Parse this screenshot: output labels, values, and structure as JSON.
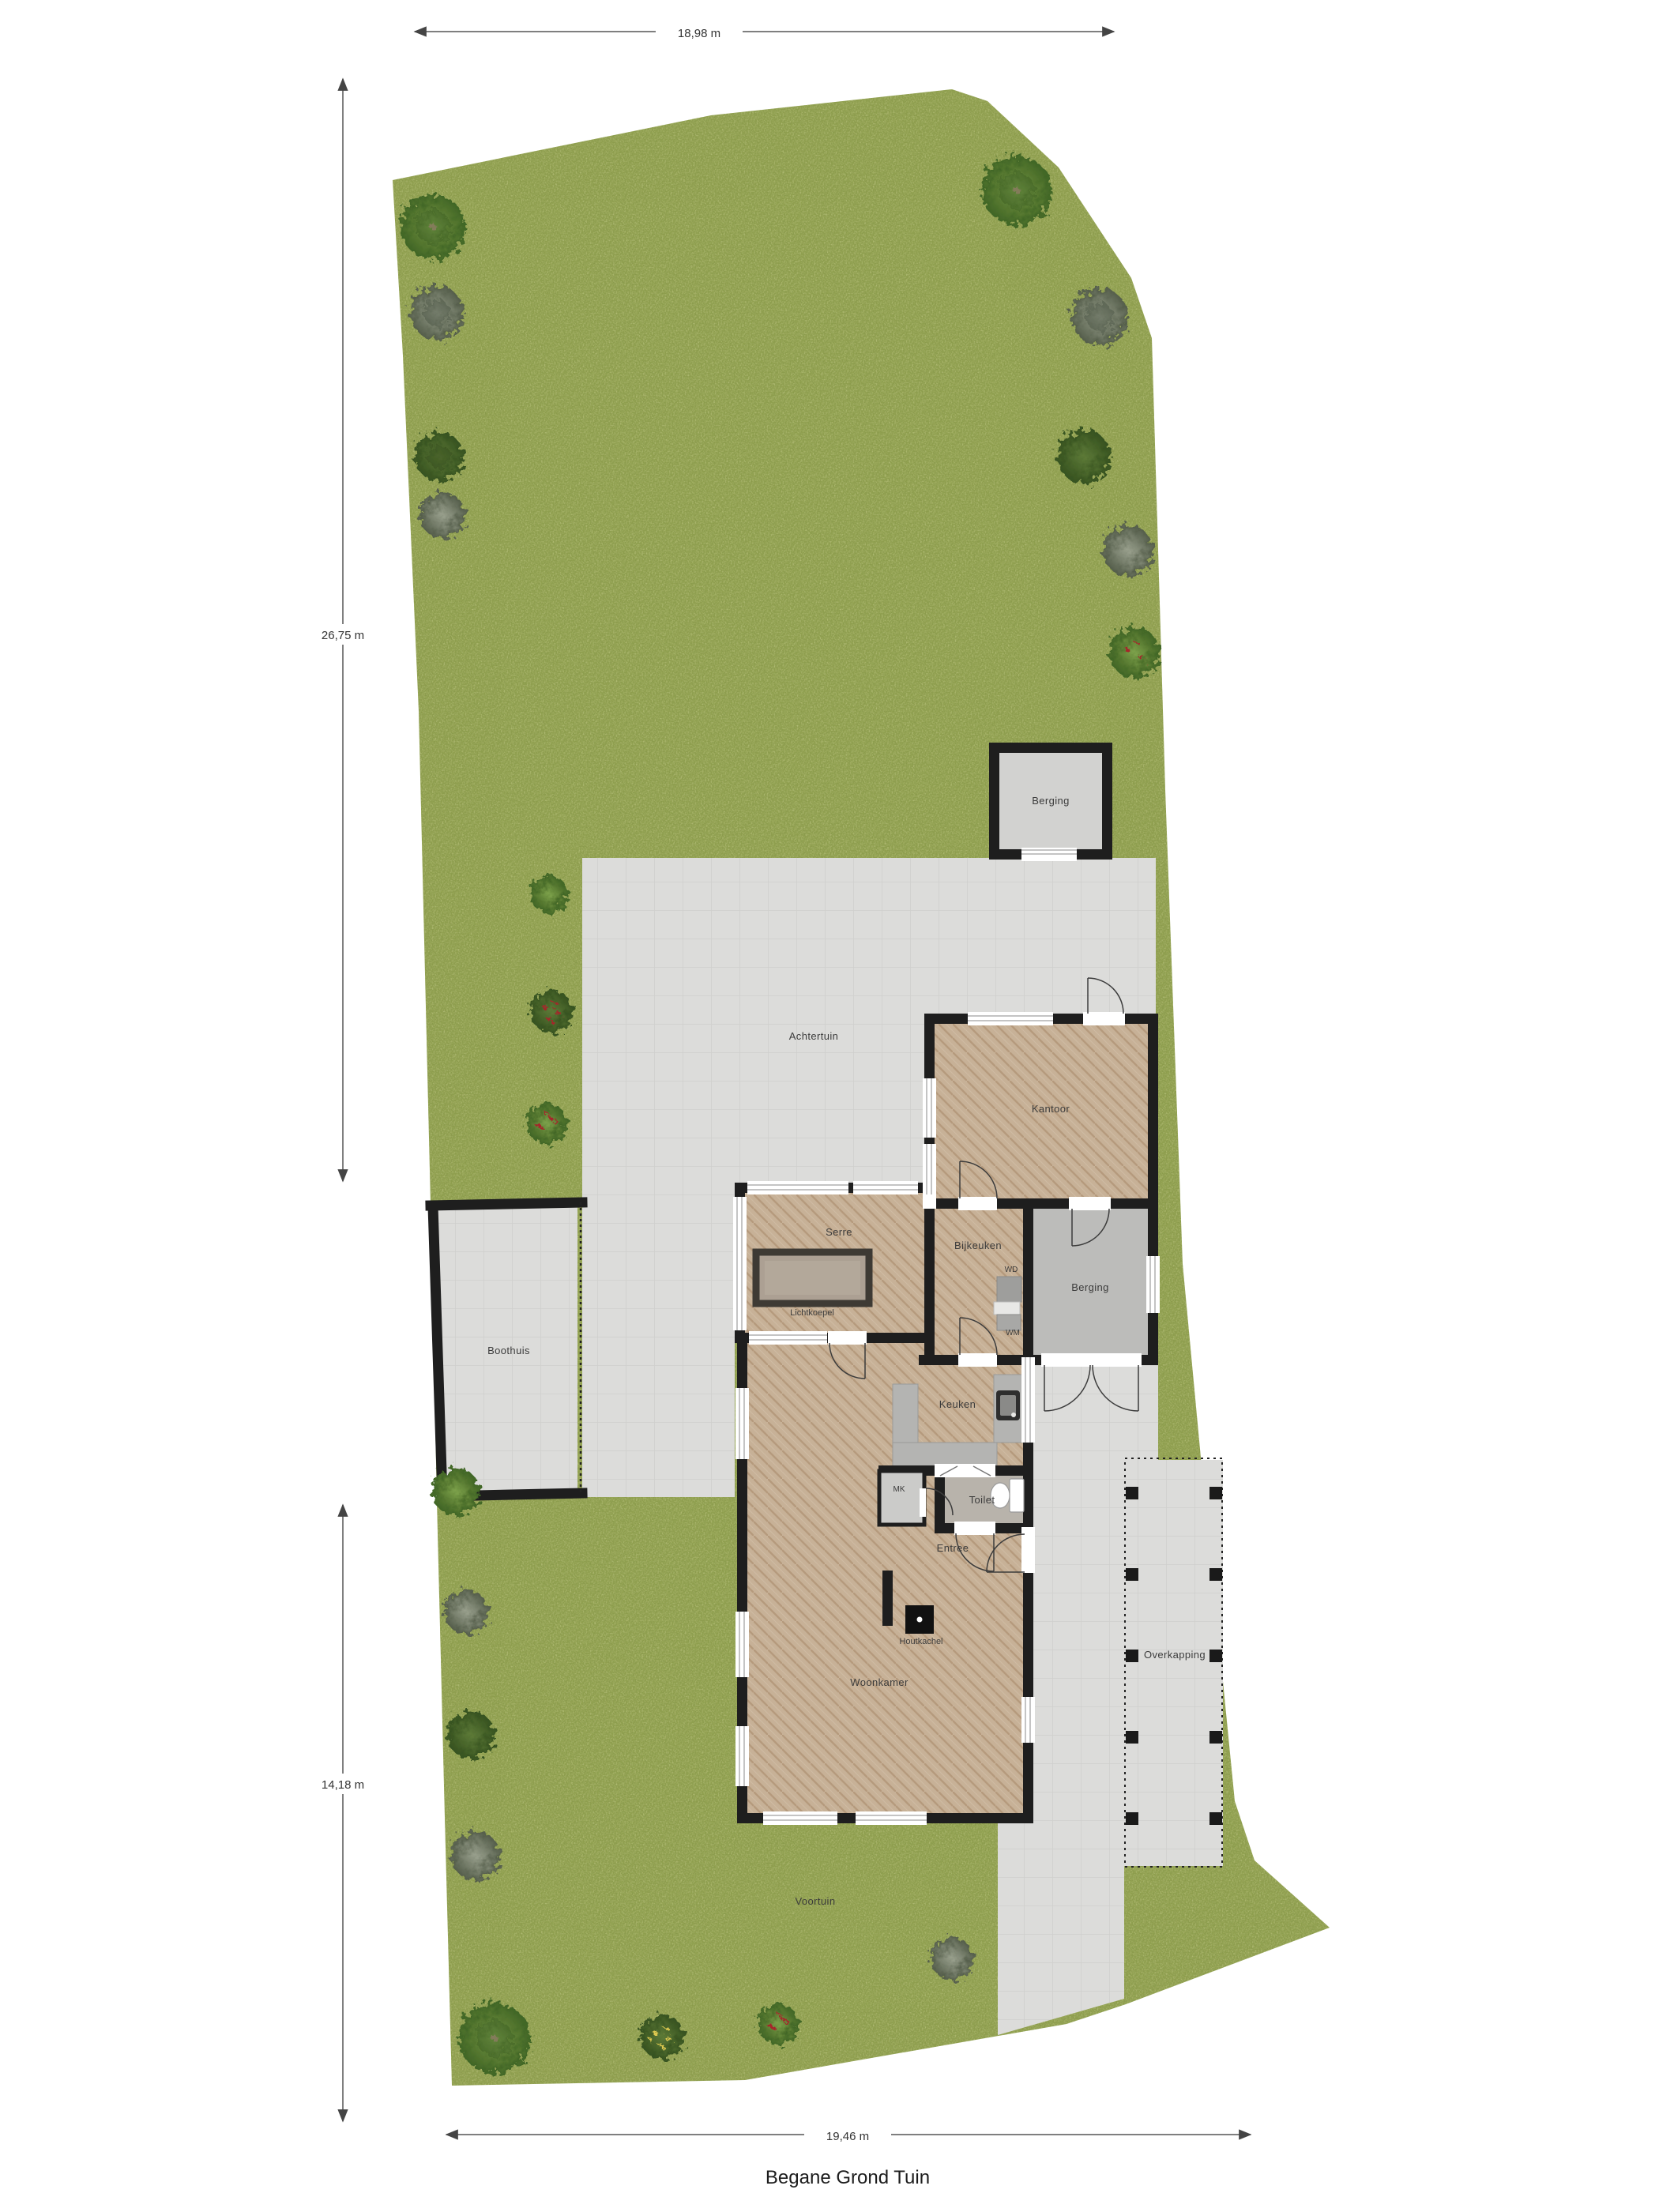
{
  "title": "Begane Grond Tuin",
  "dimensions": {
    "top": "18,98 m",
    "left_upper": "26,75 m",
    "left_lower": "14,18 m",
    "bottom": "19,46 m"
  },
  "garden_labels": {
    "achtertuin": "Achtertuin",
    "voortuin": "Voortuin"
  },
  "rooms": {
    "berging_top": "Berging",
    "kantoor": "Kantoor",
    "serre": "Serre",
    "lichtkoepel": "Lichtkoepel",
    "bijkeuken": "Bijkeuken",
    "wd": "WD",
    "wm": "WM",
    "berging": "Berging",
    "boothuis": "Boothuis",
    "keuken": "Keuken",
    "mk": "MK",
    "toilet": "Toilet",
    "entree": "Entree",
    "houtkachel": "Houtkachel",
    "woonkamer": "Woonkamer",
    "overkapping": "Overkapping"
  },
  "colors": {
    "grass": "#91a150",
    "paving": "#dcdcda",
    "wall": "#1e1e1e",
    "wood_floor": "#c7b197",
    "concrete": "#bcbcba"
  }
}
